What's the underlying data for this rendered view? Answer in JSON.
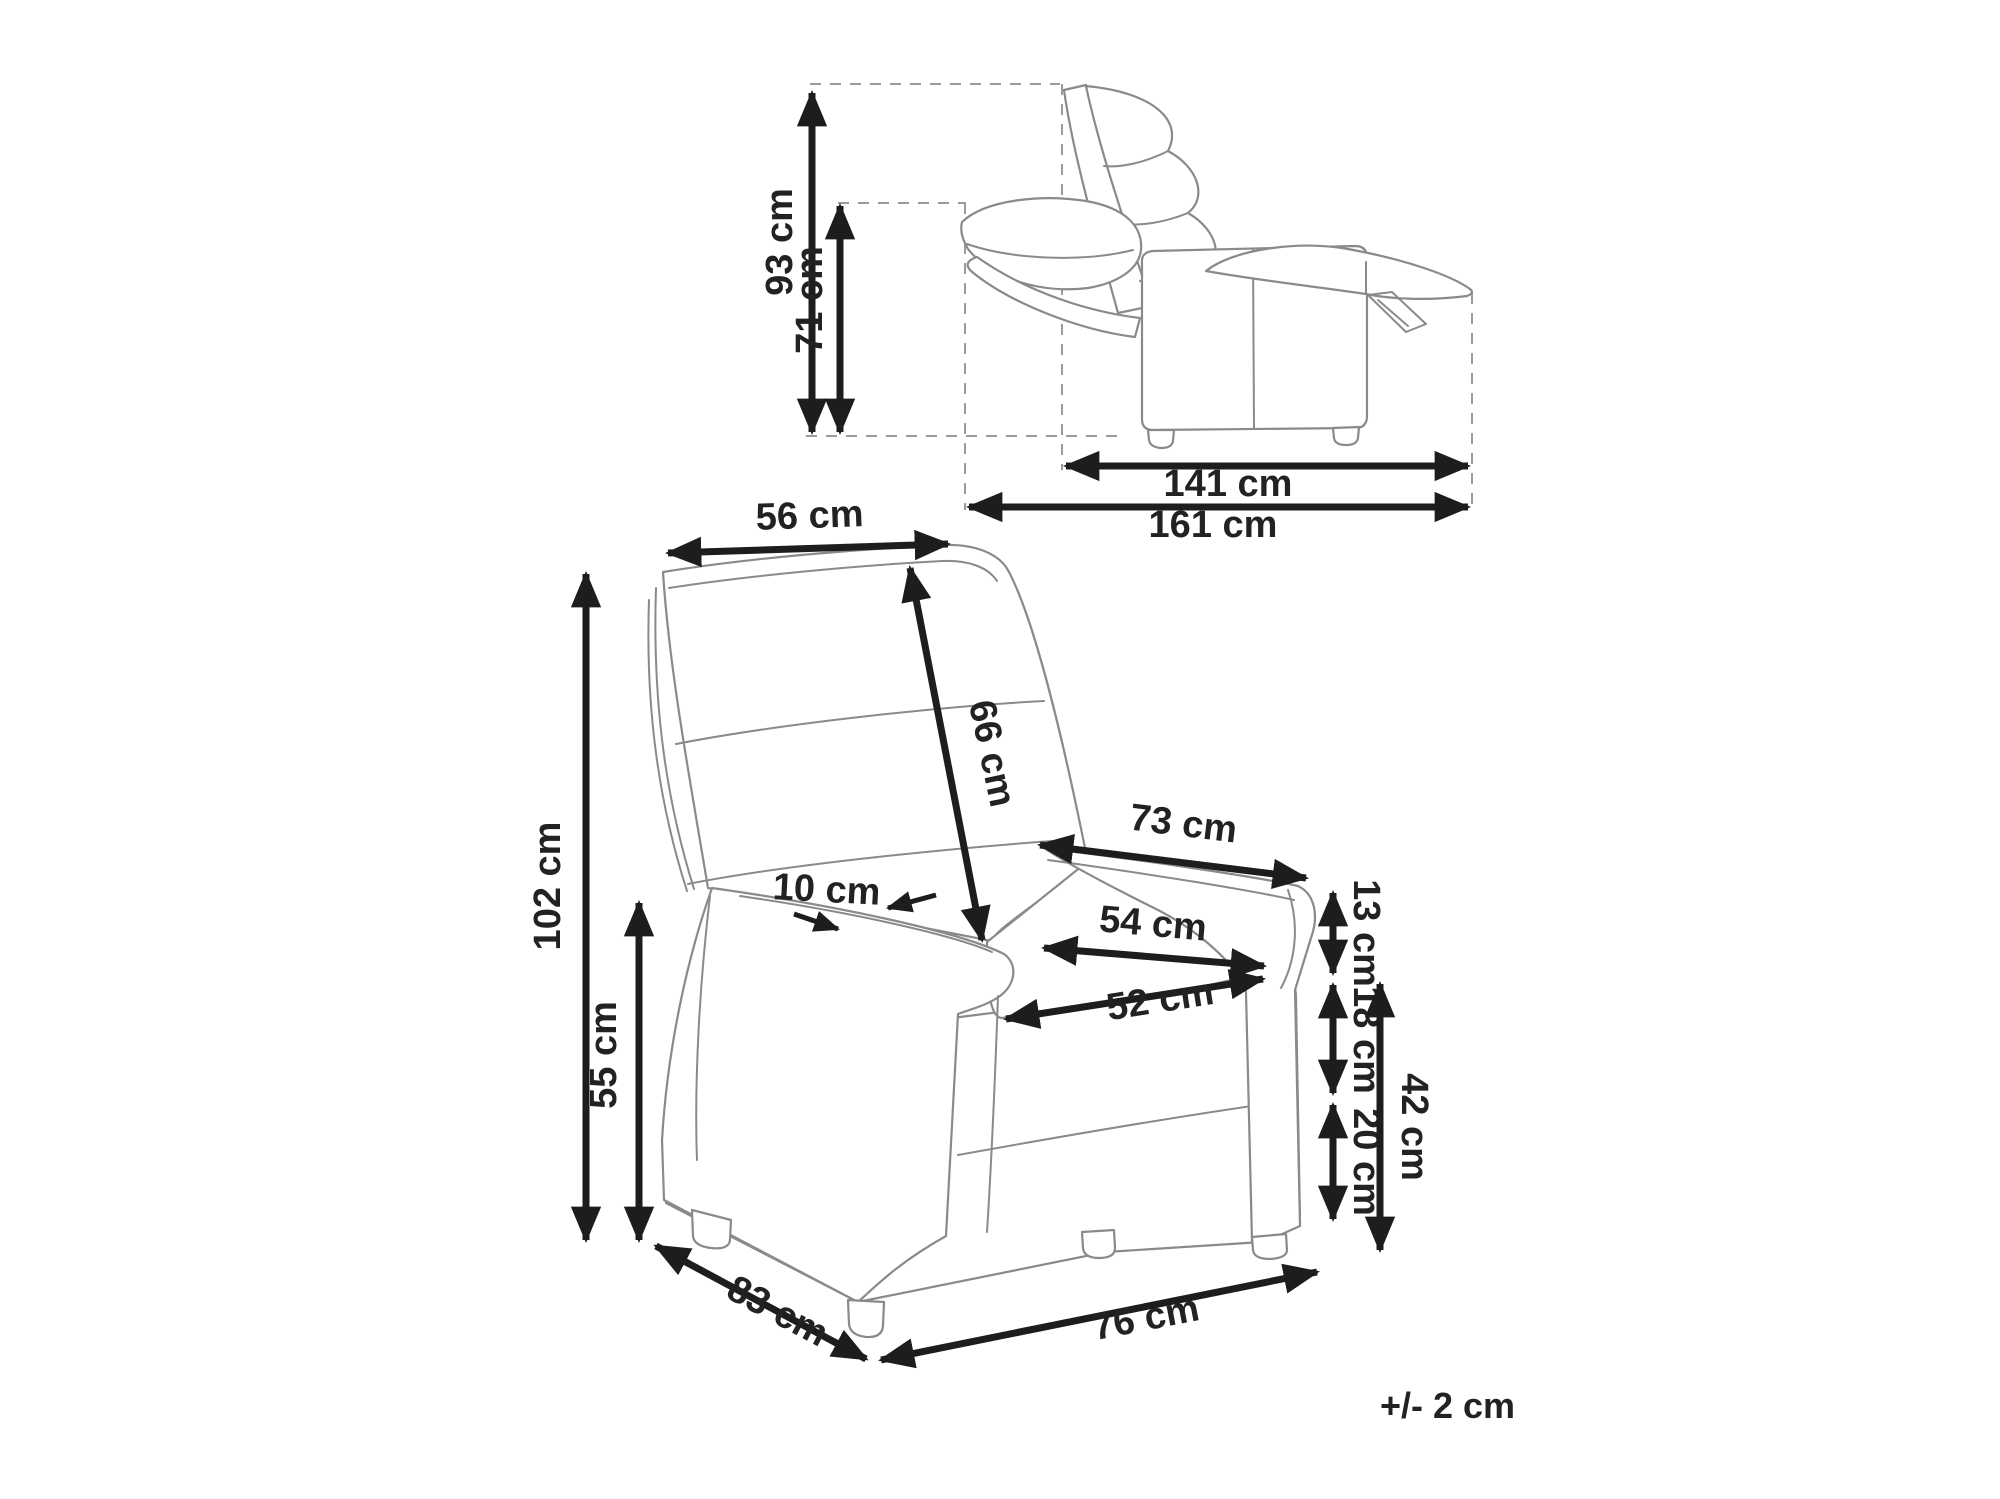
{
  "diagram": {
    "kind": "recliner-armchair dimension drawing",
    "unit": "cm",
    "tolerance_note": "+/- 2 cm",
    "side_view_reclined": {
      "height_total": "93 cm",
      "height_backrest_reclined": "71 cm",
      "length_body": "141 cm",
      "length_total": "161 cm"
    },
    "front_view": {
      "backrest_top_width": "56 cm",
      "backrest_length": "66 cm",
      "total_height": "102 cm",
      "armrest_height": "55 cm",
      "armrest_top_width": "10 cm",
      "armrest_length": "73 cm",
      "seat_width_rear": "54 cm",
      "seat_width_front": "52 cm",
      "backrest_above_armrest": "13 cm",
      "armrest_above_seat": "18 cm",
      "seat_cushion_to_floor": "20 cm",
      "seat_height": "42 cm",
      "base_depth": "83 cm",
      "base_width": "76 cm"
    }
  }
}
